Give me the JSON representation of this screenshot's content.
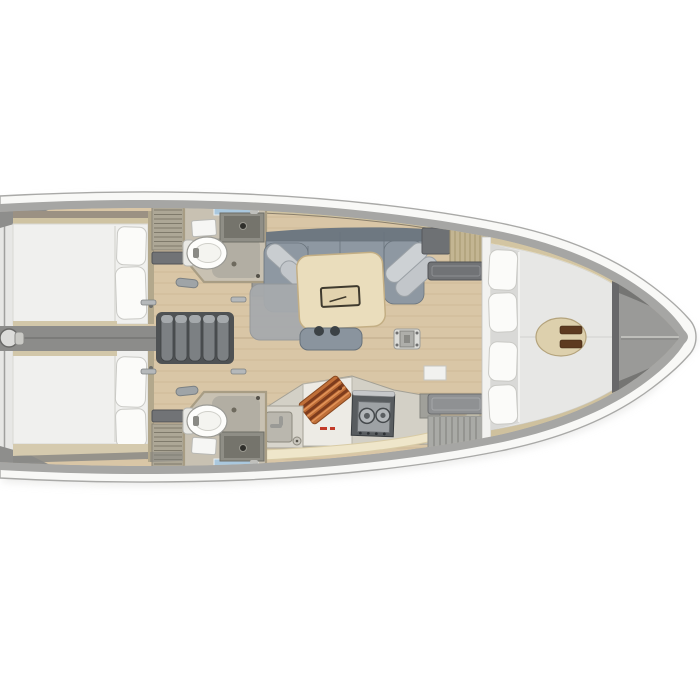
{
  "meta": {
    "title": "Sailing yacht interior layout - top-down floor plan render",
    "view": "top-down",
    "orientation": "bow-right"
  },
  "palette": {
    "page_bg": "#ffffff",
    "hull_band": "#f8f8f6",
    "hull_outline": "#a9a9a7",
    "deck": "#a6a6a4",
    "stern_corner": "#8e8e8c",
    "transom_face": "#e7e7e5",
    "wood_floor": "#d9c6a6",
    "wood_plank_line": "#c3ae87",
    "tan_trim": "#cfc3a2",
    "cabin_wall": "#b3a88c",
    "bed": "#f0f0ee",
    "pillow": "#fbfbf9",
    "center_beam": "#8c8c8a",
    "steps_frame": "#4f5254",
    "step_tread": "#7c8083",
    "louver": "#ada796",
    "shelf_dark": "#717376",
    "head_floor": "#c8c1b2",
    "head_wall": "#a89d84",
    "shower_floor": "#b2aea3",
    "sink_counter": "#8f8e86",
    "glass": "#aac8de",
    "toilet": "#fdfdfb",
    "sofa_back": "#6e7881",
    "sofa_seat": "#8e98a2",
    "sofa_cushion": "#c9cdd0",
    "rug": "#a7aaad",
    "table": "#eaddbc",
    "table_edge": "#c3ae84",
    "stool": "#8a949e",
    "galley_counter": "#d3d0c6",
    "galley_panel": "#edebe5",
    "stove": "#585c5f",
    "stove_panel": "#9ea2a5",
    "cutting_board": "#c06f38",
    "cutting_board_stripe": "#7e3c1d",
    "cream_fascia": "#efe6ca",
    "locker_tan": "#c3b592",
    "bulkhead_white": "#f2f2f0",
    "fwd_trim": "#d3c5a2",
    "fwd_mattress": "#e7e7e5",
    "fwd_pillow_strip": "#d9d9d7",
    "seat_oval": "#ddd0ad",
    "seat_inset": "#5d3a20",
    "bow_locker": "#9a9a98",
    "bow_wedge": "#757573",
    "stem": "#f0f0ee",
    "red_marking": "#c23a28",
    "metal": "#b5b8ba"
  },
  "regions": {
    "boat": "Sailing yacht hull",
    "aft_cabin_port": "Aft cabin (port)",
    "aft_cabin_starboard": "Aft cabin (starboard)",
    "companionway": "Companionway steps",
    "head_port": "Head (port)",
    "head_starboard": "Head (starboard)",
    "salon": "Salon",
    "galley": "Galley",
    "forward_cabin": "Forward cabin",
    "anchor_locker": "Anchor locker"
  }
}
